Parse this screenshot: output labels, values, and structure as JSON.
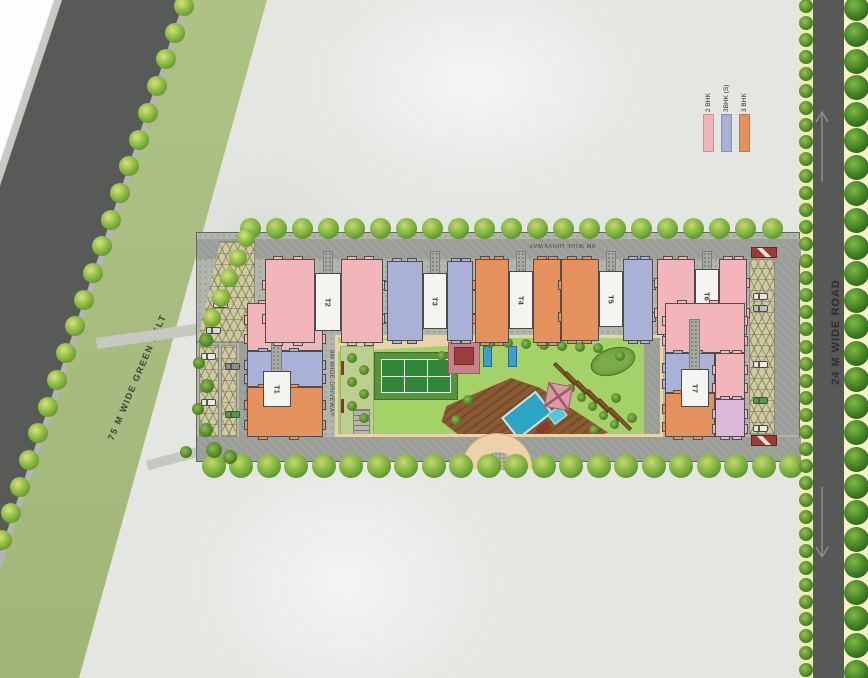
{
  "colors": {
    "unit_2bhk": "#f2b6ba",
    "unit_3bhk_s": "#a9b2d6",
    "unit_3bhk": "#e5915e",
    "unit_extra": "#dcb9d9",
    "road_dark": "#575a57",
    "green_belt": "#a9bf7e",
    "driveway": "#9b9e98",
    "lawn": "#a5d169",
    "court_green": "#2f8737",
    "pool_blue": "#2ba7c4",
    "deck_brown": "#85552f",
    "path_beige": "#e9d3a7",
    "gate_red": "#9c3a36"
  },
  "legend": {
    "items": [
      {
        "label": "2 BHK",
        "color_key": "unit_2bhk"
      },
      {
        "label": "3BHK (S)",
        "color_key": "unit_3bhk_s"
      },
      {
        "label": "3 BHK",
        "color_key": "unit_3bhk"
      }
    ]
  },
  "labels": {
    "green_belt": "75 M WIDE GREEN BELT",
    "right_road": "24 M WIDE ROAD",
    "driveway_top": "9M WIDE DRIVEWAY",
    "driveway_left": "9M WIDE DRIVEWAY",
    "driveway_inner": "9M WIDE DRIVEWAY"
  },
  "towers": [
    {
      "id": "T1",
      "units": [
        "2 BHK",
        "3BHK (S)",
        "3 BHK"
      ]
    },
    {
      "id": "T2",
      "units": [
        "2 BHK"
      ]
    },
    {
      "id": "T3",
      "units": [
        "3BHK (S)"
      ]
    },
    {
      "id": "T4",
      "units": [
        "3 BHK"
      ]
    },
    {
      "id": "T5",
      "units": [
        "3 BHK",
        "3BHK (S)"
      ]
    },
    {
      "id": "T6",
      "units": [
        "2 BHK"
      ]
    },
    {
      "id": "T7",
      "units": [
        "2 BHK",
        "3BHK (S)",
        "3 BHK"
      ]
    }
  ]
}
